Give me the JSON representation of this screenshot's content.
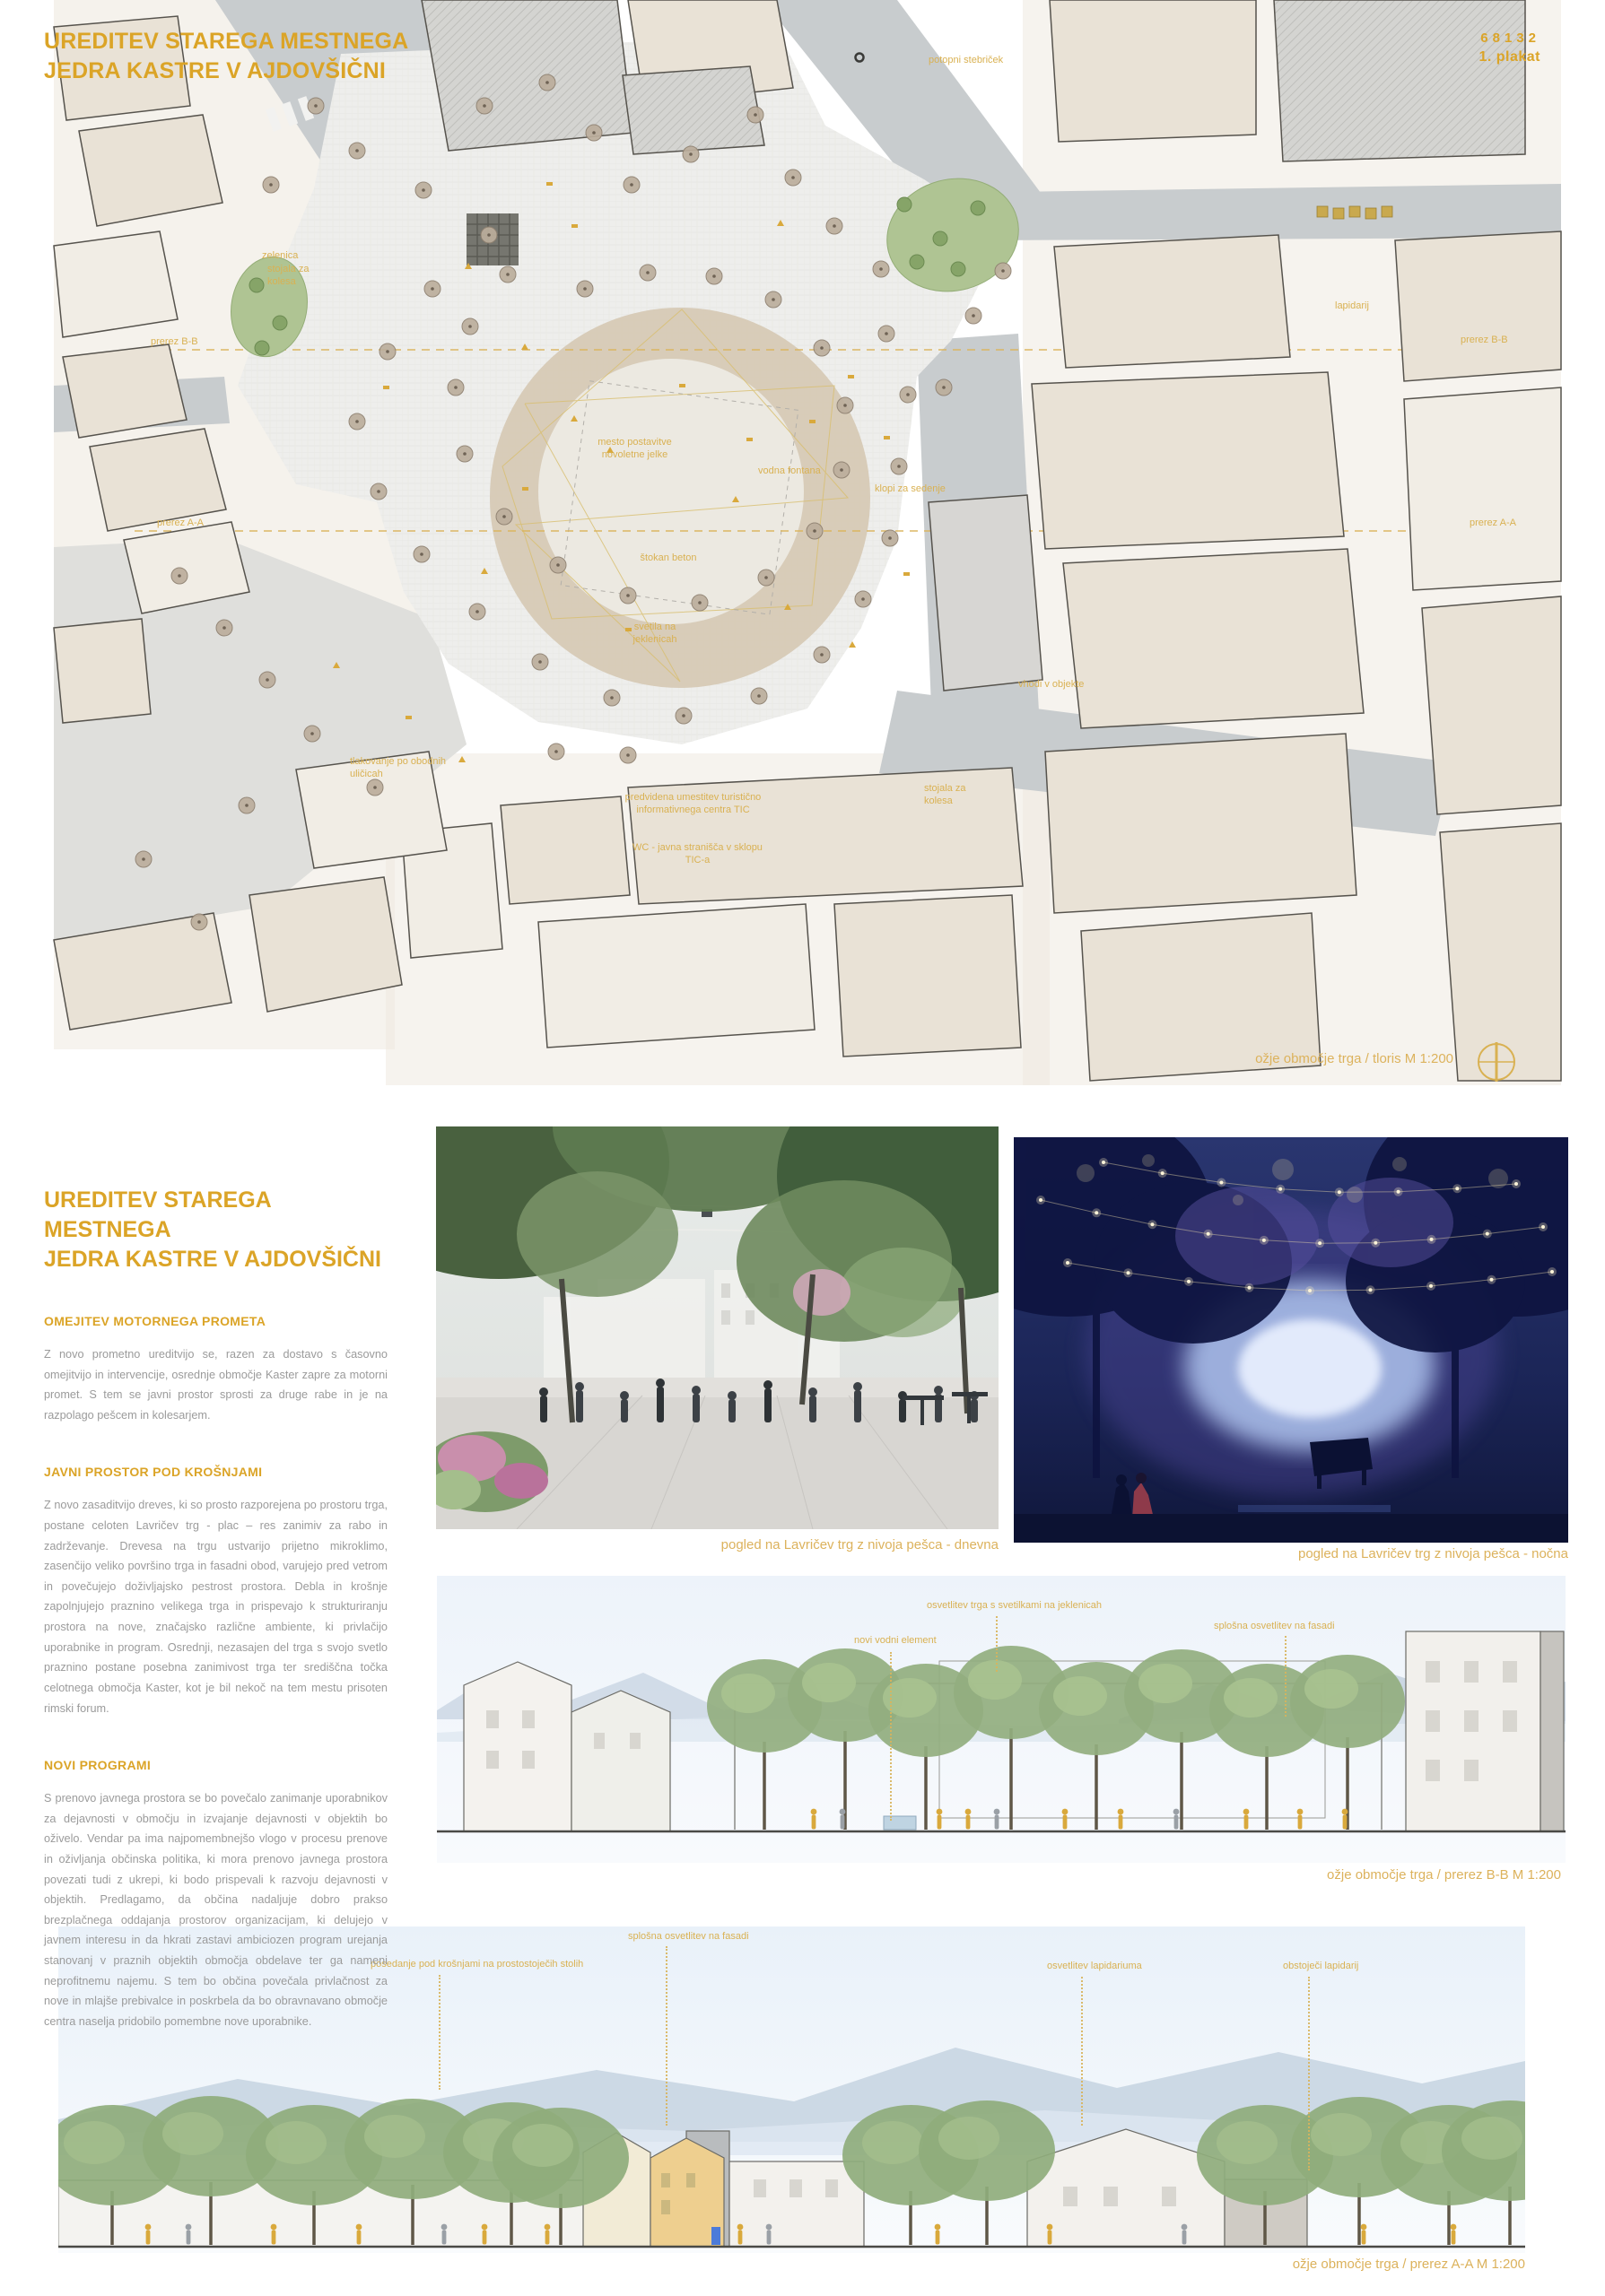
{
  "page": {
    "board_number": "68132",
    "board_label": "1. plakat"
  },
  "title": {
    "line1": "UREDITEV STAREGA MESTNEGA",
    "line2": "JEDRA KASTRE V AJDOVŠIČNI"
  },
  "colors": {
    "accent": "#DBA427",
    "label_yellow": "#D9B152",
    "body_text": "#9B9B9B"
  },
  "plan": {
    "caption": "ožje območje trga  / tloris  M 1:200",
    "labels": [
      "potopni stebriček",
      "stojala za kolesa",
      "prerez B-B",
      "prerez A-A",
      "lapidarij",
      "zelenica",
      "mesto postavitve novoletne jelke",
      "vodna fontana",
      "klopi za sedenje",
      "štokan beton",
      "svetila na jeklenicah",
      "vhodi v objekte",
      "tlakovanje po obodnih uličicah",
      "predvidena umestitev turistično informativnega centra TIC",
      "WC - javna stranišča v sklopu TIC-a"
    ]
  },
  "article": {
    "heading1": "OMEJITEV MOTORNEGA PROMETA",
    "para1": "Z novo prometno ureditvijo se, razen za dostavo s časovno omejitvijo in intervencije, osrednje območje Kaster zapre za motorni promet. S tem se javni prostor sprosti za druge rabe in je na razpolago pešcem in kolesarjem.",
    "heading2": "JAVNI PROSTOR POD KROŠNJAMI",
    "para2": "Z novo zasaditvijo dreves, ki so prosto razporejena po prostoru trga, postane celoten Lavričev trg - plac – res zanimiv za rabo in zadrževanje. Drevesa na trgu ustvarijo prijetno mikroklimo, zasenčijo veliko površino trga in fasadni obod, varujejo pred vetrom in povečujejo doživljajsko pestrost prostora. Debla in krošnje zapolnjujejo praznino velikega trga in prispevajo k strukturiranju prostora na nove, značajsko različne ambiente, ki privlačijo uporabnike in program. Osrednji, nezasajen del trga s svojo svetlo praznino postane posebna zanimivost trga ter središčna točka celotnega območja Kaster, kot je bil nekoč na tem mestu prisoten rimski forum.",
    "heading3": "NOVI PROGRAMI",
    "para3": "S prenovo javnega prostora se bo povečalo zanimanje uporabnikov za dejavnosti v območju in izvajanje dejavnosti v objektih bo oživelo. Vendar pa ima najpomembnejšo vlogo v procesu prenove in oživljanja občinska politika, ki mora prenovo javnega prostora povezati tudi z ukrepi, ki bodo prispevali k razvoju dejavnosti v objektih.  Predlagamo, da občina nadaljuje dobro prakso brezplačnega oddajanja prostorov organizacijam, ki delujejo v javnem interesu in da hkrati zastavi ambiciozen program urejanja stanovanj v praznih objektih območja obdelave ter ga nameni neprofitnemu najemu. S tem bo občina povečala privlačnost za nove in mlajše prebivalce in poskrbela da bo obravnavano območje centra naselja pridobilo pomembne nove uporabnike."
  },
  "renders": {
    "day_caption": "pogled na Lavričev trg z nivoja pešca - dnevna",
    "night_caption": "pogled na Lavričev trg z nivoja pešca - nočna"
  },
  "section_bb": {
    "labels": [
      "osvetlitev trga s svetilkami na jeklenicah",
      "novi vodni element",
      "splošna osvetlitev na fasadi"
    ],
    "caption": "ožje območje trga  / prerez B-B M 1:200"
  },
  "section_aa": {
    "labels": [
      "posedanje pod krošnjami na prostostoječih stolih",
      "splošna osvetlitev na fasadi",
      "osvetlitev lapidariuma",
      "obstoječi lapidarij"
    ],
    "caption": "ožje območje trga  / prerez A-A  M 1:200"
  }
}
